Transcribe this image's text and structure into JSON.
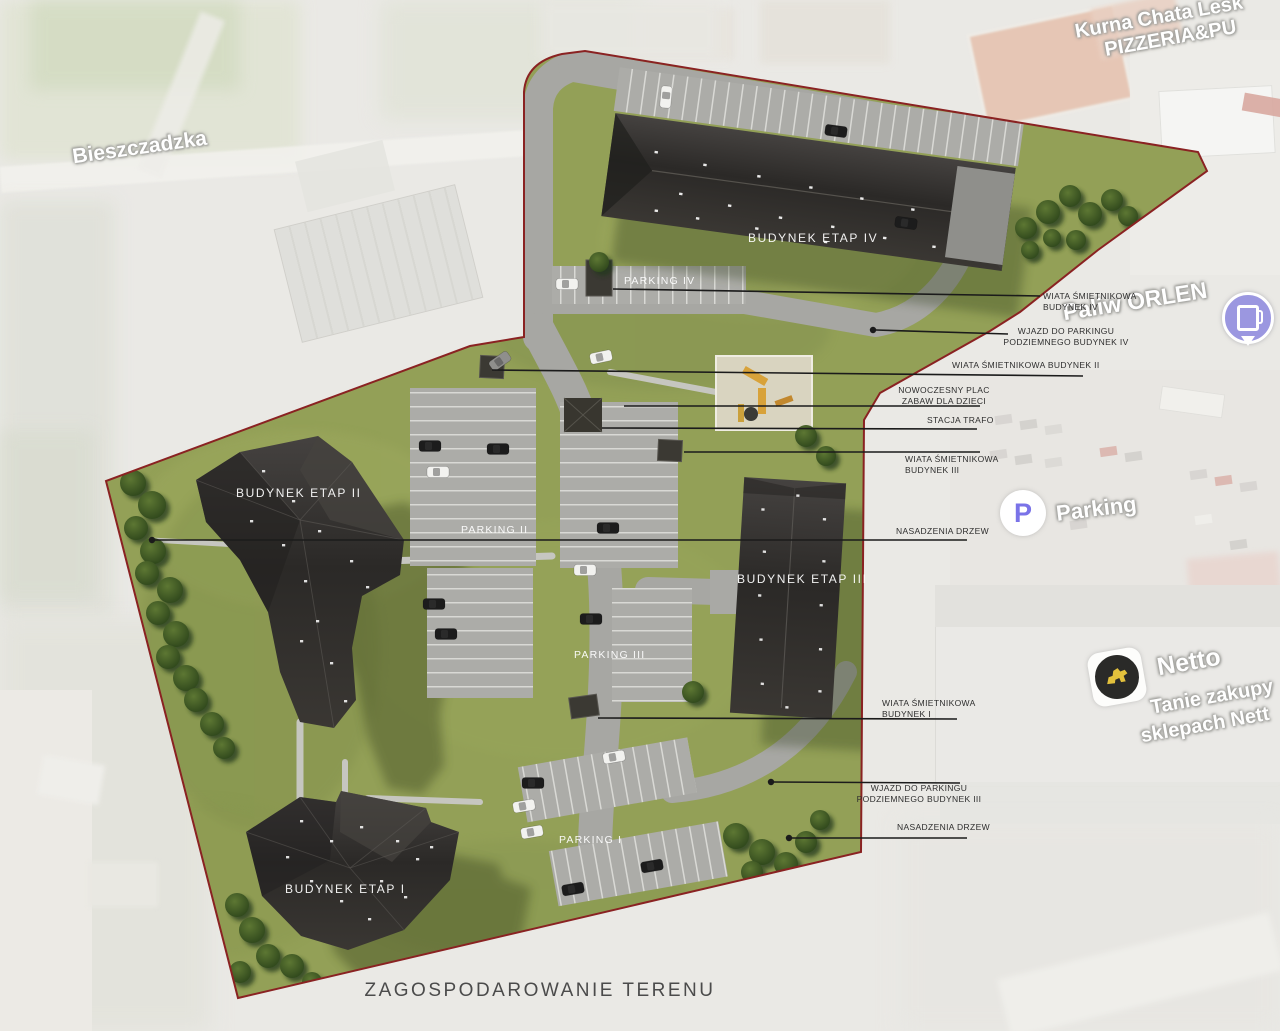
{
  "title": "ZAGOSPODAROWANIE TERENU",
  "plan_labels": {
    "budynek_etap_4": "BUDYNEK ETAP IV",
    "parking_4": "PARKING IV",
    "budynek_etap_2": "BUDYNEK ETAP II",
    "parking_2": "PARKING II",
    "budynek_etap_3": "BUDYNEK ETAP III",
    "parking_3": "PARKING III",
    "budynek_etap_1": "BUDYNEK ETAP I",
    "parking_1": "PARKING I"
  },
  "annotations": [
    {
      "id": "wiata-smietnikowa-budynek-4",
      "lines": [
        "WIATA ŚMIETNIKOWA",
        "BUDYNEK IV"
      ]
    },
    {
      "id": "wjazd-parking-podziemny-budynek-4",
      "lines": [
        "WJAZD DO PARKINGU",
        "PODZIEMNEGO BUDYNEK IV"
      ]
    },
    {
      "id": "wiata-smietnikowa-budynek-2",
      "lines": [
        "WIATA ŚMIETNIKOWA BUDYNEK II"
      ]
    },
    {
      "id": "plac-zabaw",
      "lines": [
        "NOWOCZESNY PLAC",
        "ZABAW DLA DZIECI"
      ]
    },
    {
      "id": "stacja-trafo",
      "lines": [
        "STACJA TRAFO"
      ]
    },
    {
      "id": "wiata-smietnikowa-budynek-3",
      "lines": [
        "WIATA ŚMIETNIKOWA",
        "BUDYNEK III"
      ]
    },
    {
      "id": "nasadzenia-drzew-polnoc",
      "lines": [
        "NASADZENIA DRZEW"
      ]
    },
    {
      "id": "wiata-smietnikowa-budynek-1",
      "lines": [
        "WIATA ŚMIETNIKOWA",
        "BUDYNEK I"
      ]
    },
    {
      "id": "wjazd-parking-podziemny-budynek-3",
      "lines": [
        "WJAZD DO PARKINGU",
        "PODZIEMNEGO BUDYNEK III"
      ]
    },
    {
      "id": "nasadzenia-drzew-poludnie",
      "lines": [
        "NASADZENIA DRZEW"
      ]
    }
  ],
  "map_labels": {
    "street": "Bieszczadzka",
    "restaurant_line1": "Kurna Chata Lesk",
    "restaurant_line2": "PIZZERIA&PU",
    "fuel_station": "Paliw ORLEN",
    "parking": "Parking",
    "parking_icon_letter": "P",
    "store": "Netto",
    "store_sub1": "Tanie zakupy",
    "store_sub2": "sklepach Nett"
  },
  "colors": {
    "lawn": "#93a057",
    "road": "#a7a7a3",
    "lot": "#acaca8",
    "stall_line": "#d9d9d5",
    "sidewalk": "#c6c6c0",
    "building": "#2b2927",
    "building_light": "#46433f",
    "boundary_red": "#8a2222",
    "leader_line": "#1b1b1b",
    "tree_dark": "#2c441a",
    "tree_light": "#5d7733",
    "playground_sand": "#d9d4c0",
    "playground_wood": "#d8a23a",
    "pin_indigo": "#9b97e0",
    "parking_p_purple": "#7a73e8",
    "netto_yellow": "#e3c13c"
  }
}
